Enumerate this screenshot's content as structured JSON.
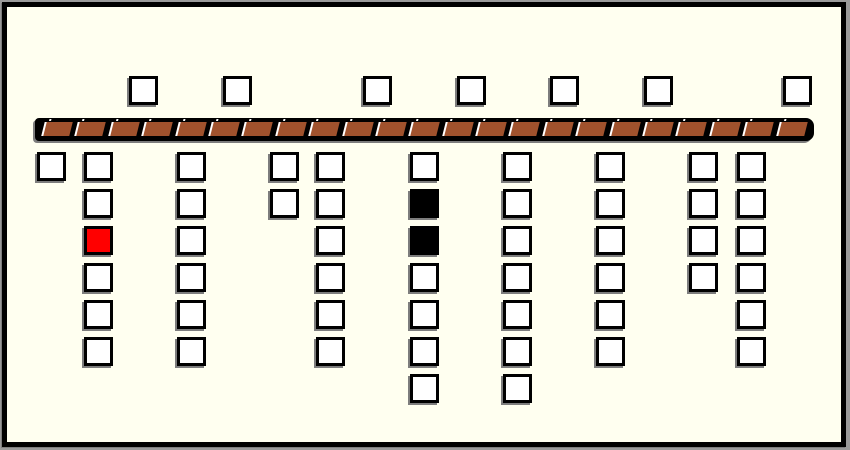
{
  "window": {
    "outer_edge_color": "#9A9A9A",
    "frame_color": "#000000",
    "panel_background": "#FFFFF0"
  },
  "diagram": {
    "kind": "rail-with-square-tokens",
    "square_size": 29,
    "colors": {
      "cell_white": "#FFFFFF",
      "cell_red": "#FF0000",
      "cell_black": "#000000",
      "rail_brown": "#A0522D",
      "rail_black": "#000000",
      "separator_white": "#FFFFFF",
      "shadow_gray": "#7D7D7D"
    },
    "rail": {
      "x": 35,
      "y": 118,
      "width": 779,
      "height": 23,
      "segments": 23
    },
    "top_row": {
      "y": 76,
      "squares_x": [
        129,
        223,
        363,
        457,
        550,
        644,
        783
      ]
    },
    "rows": {
      "y_start": 152,
      "pitch": 37
    },
    "columns": [
      {
        "x": 37,
        "cells": [
          "white"
        ]
      },
      {
        "x": 84,
        "cells": [
          "white",
          "white",
          "red",
          "white",
          "white",
          "white"
        ]
      },
      {
        "x": 177,
        "cells": [
          "white",
          "white",
          "white",
          "white",
          "white",
          "white"
        ]
      },
      {
        "x": 270,
        "cells": [
          "white",
          "white"
        ]
      },
      {
        "x": 316,
        "cells": [
          "white",
          "white",
          "white",
          "white",
          "white",
          "white"
        ]
      },
      {
        "x": 410,
        "cells": [
          "white",
          "black",
          "black",
          "white",
          "white",
          "white",
          "white"
        ]
      },
      {
        "x": 503,
        "cells": [
          "white",
          "white",
          "white",
          "white",
          "white",
          "white",
          "white"
        ]
      },
      {
        "x": 596,
        "cells": [
          "white",
          "white",
          "white",
          "white",
          "white",
          "white"
        ]
      },
      {
        "x": 689,
        "cells": [
          "white",
          "white",
          "white",
          "white"
        ]
      },
      {
        "x": 737,
        "cells": [
          "white",
          "white",
          "white",
          "white",
          "white",
          "white"
        ]
      }
    ]
  }
}
